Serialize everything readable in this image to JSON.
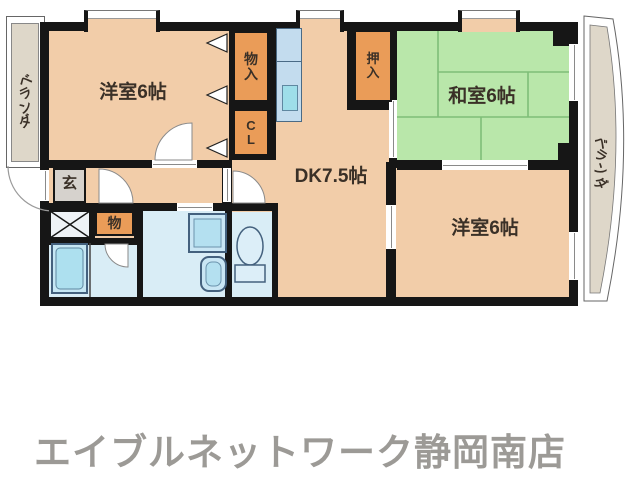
{
  "floorplan": {
    "rooms": {
      "western1": {
        "label": "洋室6帖"
      },
      "dining_kitchen": {
        "label": "DK7.5帖"
      },
      "japanese": {
        "label": "和室6帖"
      },
      "western2": {
        "label": "洋室6帖"
      },
      "balcony_left": {
        "label": "ベランダ"
      },
      "balcony_right": {
        "label": "ベランダ"
      },
      "entrance": {
        "label": "玄"
      },
      "storage_top": {
        "label": "物入"
      },
      "closet": {
        "label": "CL"
      },
      "oshiire": {
        "label": "押入"
      },
      "storage_hall": {
        "label": "物"
      }
    },
    "colors": {
      "floor": "#f2cda9",
      "tatami": "#b9e7aa",
      "tatami_line": "#7fbe77",
      "closet_orange": "#ea9c58",
      "entrance_gray": "#d6d2cd",
      "balcony_beige": "#ded7c9",
      "water_room": "#d9edf6",
      "counter": "#c3dcee",
      "sink": "#9edee9",
      "wall": "#161616",
      "footer_text": "#9c9a96"
    }
  },
  "footer": {
    "store_name": "エイブルネットワーク静岡南店"
  }
}
